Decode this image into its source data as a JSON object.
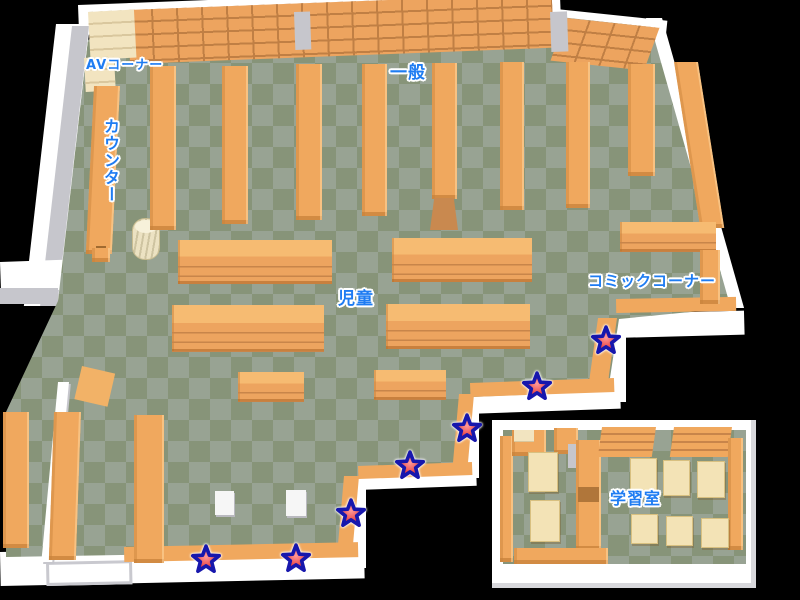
{
  "map": {
    "title": "library-floor-map",
    "areas": {
      "av_corner": {
        "label": "AVコーナー"
      },
      "counter": {
        "label": "カウンター"
      },
      "general": {
        "label": "一般"
      },
      "children": {
        "label": "児童"
      },
      "comic_corner": {
        "label": "コミックコーナー"
      },
      "study_room": {
        "label": "学習室"
      }
    },
    "stars": [
      {
        "x": 606,
        "y": 341
      },
      {
        "x": 537,
        "y": 387
      },
      {
        "x": 467,
        "y": 429
      },
      {
        "x": 410,
        "y": 466
      },
      {
        "x": 351,
        "y": 514
      },
      {
        "x": 296,
        "y": 559
      },
      {
        "x": 206,
        "y": 560
      }
    ],
    "colors": {
      "background": "#000000",
      "floor_light": "#98a393",
      "floor_dark": "#879479",
      "shelf_orange": "#f0a85e",
      "shelf_line": "#c8854a",
      "wall_white": "#ffffff",
      "wall_shade": "#c6c6cc",
      "desk_beige": "#f3e3b6",
      "label_blue": "#1e7cf2",
      "star_red": "#e23737",
      "star_outline": "#1717ad"
    }
  }
}
